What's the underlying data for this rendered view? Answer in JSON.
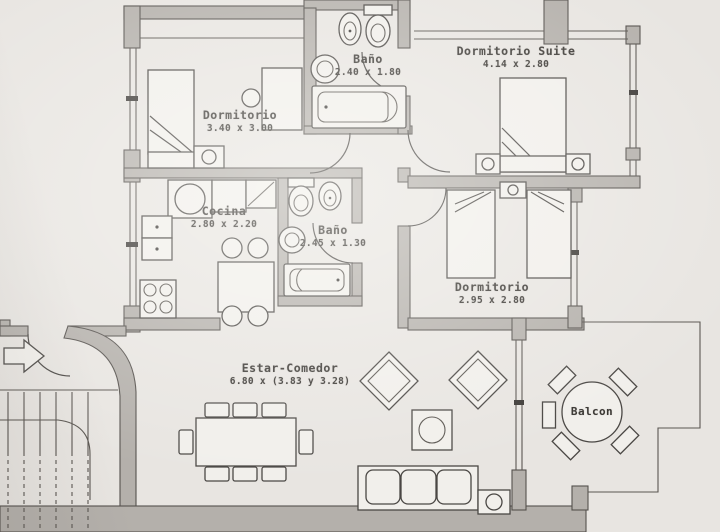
{
  "rooms": [
    {
      "name": "Dormitorio",
      "dims": "3.40 x 3.00"
    },
    {
      "name": "Baño",
      "dims": "2.40 x 1.80"
    },
    {
      "name": "Dormitorio Suite",
      "dims": "4.14 x 2.80"
    },
    {
      "name": "Cocina",
      "dims": "2.80 x 2.20"
    },
    {
      "name": "Baño",
      "dims": "2.45 x 1.30"
    },
    {
      "name": "Dormitorio",
      "dims": "2.95 x 2.80"
    },
    {
      "name": "Estar-Comedor",
      "dims": "6.80 x (3.83 y 3.28)"
    },
    {
      "name": "Balcon",
      "dims": ""
    }
  ],
  "colors": {
    "paper": "#e8e5e1",
    "wall": "#b4b0ab",
    "line": "#4a4744",
    "text": "#3a3733"
  }
}
